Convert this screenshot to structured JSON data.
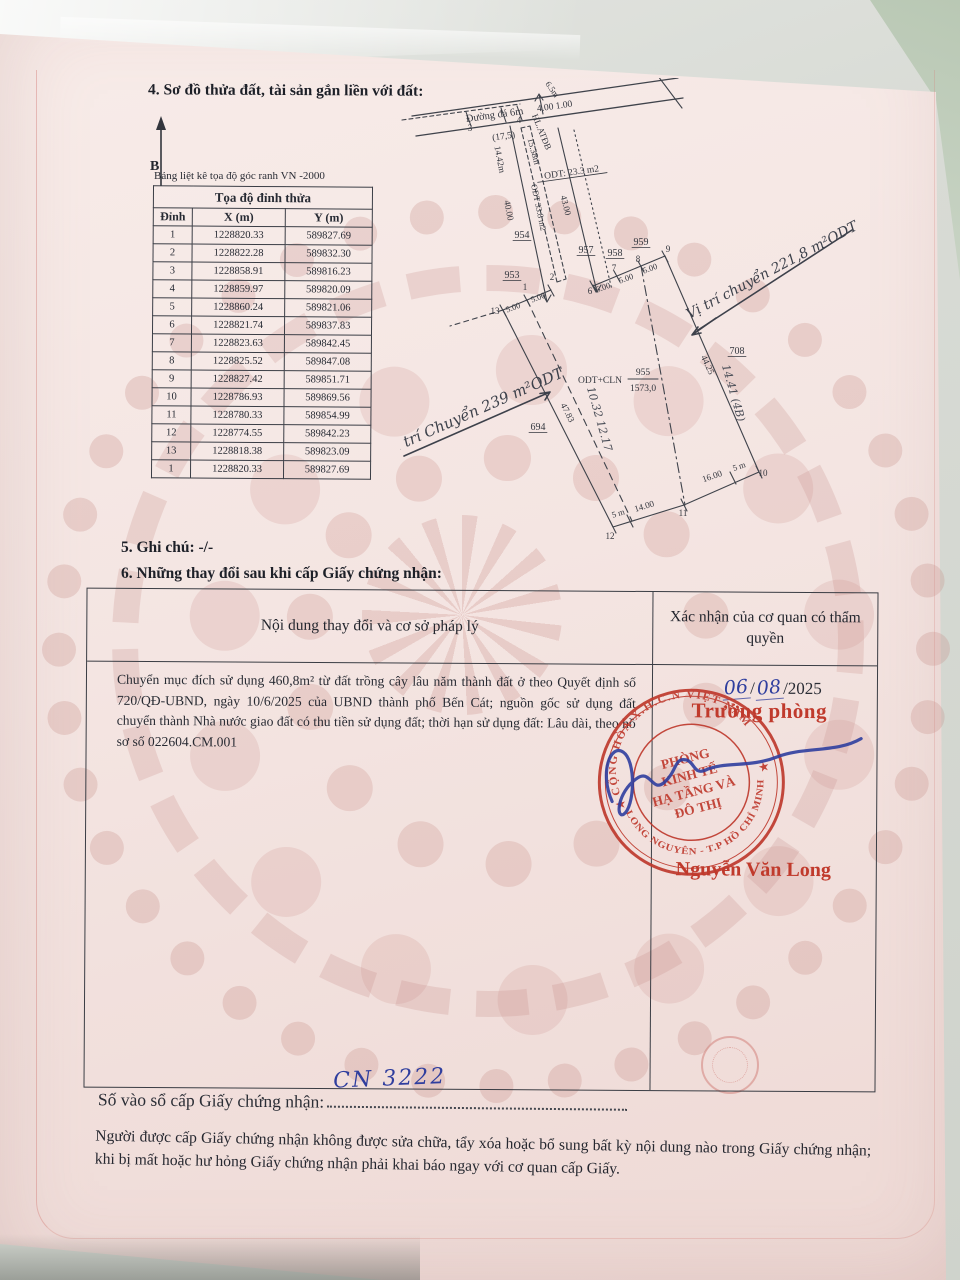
{
  "colors": {
    "stamp_red": "#bf3a2e",
    "ink_blue": "#2f3e9e",
    "paper_pink": "#f4e5e2"
  },
  "section4": {
    "title": "4. Sơ đồ thửa đất, tài sản gắn liền với đất:",
    "north_label": "B"
  },
  "coord_table": {
    "caption": "Bảng liệt kê tọa độ góc ranh VN -2000",
    "title": "Tọa độ đỉnh thửa",
    "columns": [
      "Đỉnh",
      "X (m)",
      "Y (m)"
    ],
    "rows": [
      [
        "1",
        "1228820.33",
        "589827.69"
      ],
      [
        "2",
        "1228822.28",
        "589832.30"
      ],
      [
        "3",
        "1228858.91",
        "589816.23"
      ],
      [
        "4",
        "1228859.97",
        "589820.09"
      ],
      [
        "5",
        "1228860.24",
        "589821.06"
      ],
      [
        "6",
        "1228821.74",
        "589837.83"
      ],
      [
        "7",
        "1228823.63",
        "589842.45"
      ],
      [
        "8",
        "1228825.52",
        "589847.08"
      ],
      [
        "9",
        "1228827.42",
        "589851.71"
      ],
      [
        "10",
        "1228786.93",
        "589869.56"
      ],
      [
        "11",
        "1228780.33",
        "589854.99"
      ],
      [
        "12",
        "1228774.55",
        "589842.23"
      ],
      [
        "13",
        "1228818.38",
        "589823.09"
      ],
      [
        "1",
        "1228820.33",
        "589827.69"
      ]
    ]
  },
  "diagram": {
    "texts": [
      {
        "t": "Đường đá 6m",
        "x": 95,
        "y": 40,
        "r": -8,
        "s": 10.5,
        "k": "p"
      },
      {
        "t": "4.00 1.00",
        "x": 155,
        "y": 31,
        "r": -8,
        "s": 9.5,
        "k": "p"
      },
      {
        "t": "3",
        "x": 70,
        "y": 53,
        "r": 0,
        "s": 9,
        "k": "p"
      },
      {
        "t": "4",
        "x": 119,
        "y": 45,
        "r": 0,
        "s": 9,
        "k": "p"
      },
      {
        "t": "(17,5)",
        "x": 104,
        "y": 61,
        "r": -8,
        "s": 9.5,
        "k": "p"
      },
      {
        "t": "HL.ATĐB",
        "x": 139,
        "y": 55,
        "r": 68,
        "s": 9,
        "k": "p"
      },
      {
        "t": "6.5m",
        "x": 150,
        "y": 13,
        "r": 55,
        "s": 8.5,
        "k": "p"
      },
      {
        "t": "14.42m",
        "x": 97,
        "y": 82,
        "r": 79,
        "s": 9,
        "k": "p"
      },
      {
        "t": "15.38m",
        "x": 131,
        "y": 74,
        "r": 75,
        "s": 9,
        "k": "p"
      },
      {
        "t": "ODT: 23.3 m2",
        "x": 172,
        "y": 97,
        "r": -8,
        "s": 9.5,
        "k": "u"
      },
      {
        "t": "40.00",
        "x": 106,
        "y": 133,
        "r": 79,
        "s": 9,
        "k": "p"
      },
      {
        "t": "ODT 33.8 m2",
        "x": 136,
        "y": 130,
        "r": 78,
        "s": 8.5,
        "k": "p"
      },
      {
        "t": "43.00",
        "x": 163,
        "y": 128,
        "r": 76,
        "s": 9,
        "k": "p"
      },
      {
        "t": "954",
        "x": 122,
        "y": 160,
        "r": 0,
        "s": 10,
        "k": "u"
      },
      {
        "t": "953",
        "x": 112,
        "y": 200,
        "r": 0,
        "s": 10,
        "k": "u"
      },
      {
        "t": "957",
        "x": 186,
        "y": 175,
        "r": 0,
        "s": 10,
        "k": "u"
      },
      {
        "t": "958",
        "x": 215,
        "y": 178,
        "r": 0,
        "s": 10,
        "k": "u"
      },
      {
        "t": "959",
        "x": 241,
        "y": 167,
        "r": 0,
        "s": 10,
        "k": "u"
      },
      {
        "t": "13",
        "x": 95,
        "y": 236,
        "r": 0,
        "s": 9,
        "k": "p"
      },
      {
        "t": "1",
        "x": 125,
        "y": 212,
        "r": 0,
        "s": 9,
        "k": "p"
      },
      {
        "t": "2",
        "x": 152,
        "y": 202,
        "r": 0,
        "s": 9,
        "k": "p"
      },
      {
        "t": "5.00",
        "x": 114,
        "y": 232,
        "r": -21,
        "s": 8.5,
        "k": "p"
      },
      {
        "t": "5.00",
        "x": 139,
        "y": 222,
        "r": -21,
        "s": 8.5,
        "k": "p"
      },
      {
        "t": "6",
        "x": 190,
        "y": 216,
        "r": 0,
        "s": 9,
        "k": "p"
      },
      {
        "t": "7",
        "x": 214,
        "y": 193,
        "r": 0,
        "s": 9,
        "k": "p"
      },
      {
        "t": "8",
        "x": 238,
        "y": 184,
        "r": 0,
        "s": 9,
        "k": "p"
      },
      {
        "t": "9",
        "x": 268,
        "y": 174,
        "r": 0,
        "s": 9,
        "k": "p"
      },
      {
        "t": "5.00",
        "x": 204,
        "y": 212,
        "r": -21,
        "s": 8.5,
        "k": "p"
      },
      {
        "t": "5.00",
        "x": 227,
        "y": 203,
        "r": -21,
        "s": 8.5,
        "k": "p"
      },
      {
        "t": "5.00",
        "x": 251,
        "y": 193,
        "r": -21,
        "s": 8.5,
        "k": "p"
      },
      {
        "t": "47.83",
        "x": 165,
        "y": 336,
        "r": 63,
        "s": 9,
        "k": "p"
      },
      {
        "t": "44.25",
        "x": 305,
        "y": 288,
        "r": 65,
        "s": 9,
        "k": "p"
      },
      {
        "t": "708",
        "x": 337,
        "y": 276,
        "r": 0,
        "s": 10,
        "k": "u"
      },
      {
        "t": "694",
        "x": 138,
        "y": 352,
        "r": 0,
        "s": 10,
        "k": "u"
      },
      {
        "t": "ODT+CLN",
        "x": 200,
        "y": 305,
        "r": 0,
        "s": 9.5,
        "k": "p"
      },
      {
        "t": "955",
        "x": 243,
        "y": 297,
        "r": 0,
        "s": 9.5,
        "k": "p"
      },
      {
        "t": "1573,0",
        "x": 243,
        "y": 313,
        "r": 0,
        "s": 9.5,
        "k": "p"
      },
      {
        "t": "12",
        "x": 210,
        "y": 461,
        "r": 0,
        "s": 9,
        "k": "p"
      },
      {
        "t": "11",
        "x": 283,
        "y": 438,
        "r": 0,
        "s": 9,
        "k": "p"
      },
      {
        "t": "10",
        "x": 363,
        "y": 398,
        "r": 0,
        "s": 9,
        "k": "p"
      },
      {
        "t": "5 m",
        "x": 219,
        "y": 438,
        "r": -17,
        "s": 8.5,
        "k": "p"
      },
      {
        "t": "14.00",
        "x": 245,
        "y": 431,
        "r": -17,
        "s": 9,
        "k": "p"
      },
      {
        "t": "16.00",
        "x": 313,
        "y": 401,
        "r": -19,
        "s": 9,
        "k": "p"
      },
      {
        "t": "5 m",
        "x": 340,
        "y": 391,
        "r": -19,
        "s": 8.5,
        "k": "p"
      },
      {
        "t": "Vị trí Chuyển 239 m²ODT",
        "x": 76,
        "y": 338,
        "r": -24,
        "s": 15,
        "k": "h"
      },
      {
        "t": "Vị trí chuyển 221,8 m²ODT",
        "x": 374,
        "y": 196,
        "r": -28,
        "s": 14,
        "k": "h"
      },
      {
        "t": "10.32 12.17",
        "x": 196,
        "y": 342,
        "r": 74,
        "s": 11,
        "k": "hs"
      },
      {
        "t": "14.41 (4B)",
        "x": 330,
        "y": 316,
        "r": 74,
        "s": 11,
        "k": "hs"
      }
    ]
  },
  "section5": {
    "title": "5. Ghi chú: -/-"
  },
  "section6": {
    "title": "6. Những thay đổi sau khi cấp Giấy chứng nhận:"
  },
  "changes_table": {
    "col1_header": "Nội dung thay đổi và cơ sở pháp lý",
    "col2_header": "Xác nhận của cơ quan có thẩm quyền",
    "entry_text": "Chuyển mục đích sử dụng 460,8m² từ đất trồng cây lâu năm thành đất ở theo Quyết định số 720/QĐ-UBND, ngày 10/6/2025 của UBND thành phố Bến Cát; nguồn gốc sử dụng đất chuyển thành Nhà nước giao đất có thu tiền sử dụng đất; thời hạn sử dụng đất: Lâu dài, theo hồ sơ số 022604.CM.001",
    "approval": {
      "date_day": "06",
      "date_month": "08",
      "date_sep": "/",
      "date_year": "/2025",
      "title": "Trưởng phòng",
      "signer": "Nguyễn Văn Long",
      "stamp": {
        "top_text": "CỘNG HÒA X.H.C.N VIỆT NAM",
        "bottom_text": "LONG NGUYÊN - T.P HỒ CHÍ MINH",
        "star": "★",
        "center_lines": [
          "PHÒNG",
          "KINH TẾ",
          "HẠ TẦNG VÀ",
          "ĐÔ THỊ"
        ]
      }
    }
  },
  "footer": {
    "serial_label": "Số vào sổ cấp Giấy chứng nhận:",
    "serial_value": "CN 3222",
    "notice": "Người được cấp Giấy chứng nhận không được sửa chữa, tẩy xóa hoặc bổ sung bất kỳ nội dung nào trong Giấy chứng nhận; khi bị mất hoặc hư hỏng Giấy chứng nhận phải khai báo ngay với cơ quan cấp Giấy."
  }
}
